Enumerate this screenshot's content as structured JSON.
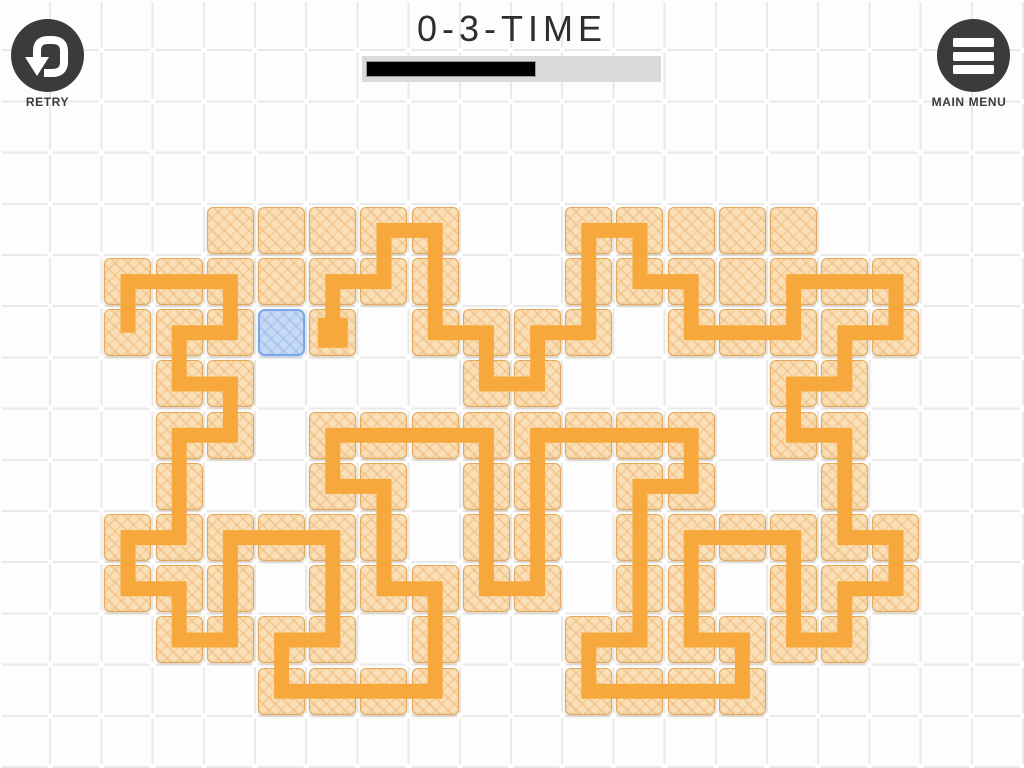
{
  "header": {
    "title": "0-3-TIME",
    "retry_label": "RETRY",
    "main_menu_label": "MAIN MENU",
    "progress": {
      "value_pct": 58
    }
  },
  "colors": {
    "path_orange": "#F7A83D",
    "tile_fill": "#FAE0B8",
    "tile_border": "#E0A050",
    "cursor_fill": "#C6DAF8",
    "cursor_border": "#79A7EA",
    "button_dark": "#3B3B3D",
    "progress_track": "#DADADA",
    "progress_fill": "#000000",
    "grid_line": "#E9E9E9",
    "title_color": "#2E2E2E"
  },
  "board": {
    "cell_size": 51.2,
    "cols": 20,
    "rows": 15,
    "path_width": 15,
    "start_marker_size": 30,
    "cursor_cell": [
      5,
      6
    ],
    "start_cell": [
      6,
      6
    ],
    "tiles": [
      [
        4,
        4
      ],
      [
        5,
        4
      ],
      [
        6,
        4
      ],
      [
        7,
        4
      ],
      [
        8,
        4
      ],
      [
        11,
        4
      ],
      [
        12,
        4
      ],
      [
        13,
        4
      ],
      [
        14,
        4
      ],
      [
        15,
        4
      ],
      [
        2,
        5
      ],
      [
        3,
        5
      ],
      [
        4,
        5
      ],
      [
        5,
        5
      ],
      [
        6,
        5
      ],
      [
        7,
        5
      ],
      [
        8,
        5
      ],
      [
        11,
        5
      ],
      [
        12,
        5
      ],
      [
        13,
        5
      ],
      [
        14,
        5
      ],
      [
        15,
        5
      ],
      [
        16,
        5
      ],
      [
        17,
        5
      ],
      [
        2,
        6
      ],
      [
        3,
        6
      ],
      [
        4,
        6
      ],
      [
        6,
        6
      ],
      [
        8,
        6
      ],
      [
        9,
        6
      ],
      [
        10,
        6
      ],
      [
        11,
        6
      ],
      [
        13,
        6
      ],
      [
        14,
        6
      ],
      [
        15,
        6
      ],
      [
        16,
        6
      ],
      [
        17,
        6
      ],
      [
        3,
        7
      ],
      [
        4,
        7
      ],
      [
        9,
        7
      ],
      [
        10,
        7
      ],
      [
        15,
        7
      ],
      [
        16,
        7
      ],
      [
        3,
        8
      ],
      [
        4,
        8
      ],
      [
        6,
        8
      ],
      [
        7,
        8
      ],
      [
        8,
        8
      ],
      [
        9,
        8
      ],
      [
        10,
        8
      ],
      [
        11,
        8
      ],
      [
        12,
        8
      ],
      [
        13,
        8
      ],
      [
        15,
        8
      ],
      [
        16,
        8
      ],
      [
        3,
        9
      ],
      [
        6,
        9
      ],
      [
        7,
        9
      ],
      [
        9,
        9
      ],
      [
        10,
        9
      ],
      [
        12,
        9
      ],
      [
        13,
        9
      ],
      [
        16,
        9
      ],
      [
        2,
        10
      ],
      [
        3,
        10
      ],
      [
        4,
        10
      ],
      [
        5,
        10
      ],
      [
        6,
        10
      ],
      [
        7,
        10
      ],
      [
        9,
        10
      ],
      [
        10,
        10
      ],
      [
        12,
        10
      ],
      [
        13,
        10
      ],
      [
        14,
        10
      ],
      [
        15,
        10
      ],
      [
        16,
        10
      ],
      [
        17,
        10
      ],
      [
        2,
        11
      ],
      [
        3,
        11
      ],
      [
        4,
        11
      ],
      [
        6,
        11
      ],
      [
        7,
        11
      ],
      [
        8,
        11
      ],
      [
        9,
        11
      ],
      [
        10,
        11
      ],
      [
        12,
        11
      ],
      [
        13,
        11
      ],
      [
        15,
        11
      ],
      [
        16,
        11
      ],
      [
        17,
        11
      ],
      [
        3,
        12
      ],
      [
        4,
        12
      ],
      [
        5,
        12
      ],
      [
        6,
        12
      ],
      [
        8,
        12
      ],
      [
        11,
        12
      ],
      [
        12,
        12
      ],
      [
        13,
        12
      ],
      [
        14,
        12
      ],
      [
        15,
        12
      ],
      [
        16,
        12
      ],
      [
        5,
        13
      ],
      [
        6,
        13
      ],
      [
        7,
        13
      ],
      [
        8,
        13
      ],
      [
        11,
        13
      ],
      [
        12,
        13
      ],
      [
        13,
        13
      ],
      [
        14,
        13
      ]
    ],
    "path_points": [
      [
        332.8,
        332.8
      ],
      [
        332.8,
        281.6
      ],
      [
        384,
        281.6
      ],
      [
        384,
        230.4
      ],
      [
        435.2,
        230.4
      ],
      [
        435.2,
        332.8
      ],
      [
        486.4,
        332.8
      ],
      [
        486.4,
        384
      ],
      [
        537.6,
        384
      ],
      [
        537.6,
        332.8
      ],
      [
        588.8,
        332.8
      ],
      [
        588.8,
        230.4
      ],
      [
        640,
        230.4
      ],
      [
        640,
        281.6
      ],
      [
        691.2,
        281.6
      ],
      [
        691.2,
        332.8
      ],
      [
        793.6,
        332.8
      ],
      [
        793.6,
        281.6
      ],
      [
        896,
        281.6
      ],
      [
        896,
        332.8
      ],
      [
        844.8,
        332.8
      ],
      [
        844.8,
        384
      ],
      [
        793.6,
        384
      ],
      [
        793.6,
        435.2
      ],
      [
        844.8,
        435.2
      ],
      [
        844.8,
        537.6
      ],
      [
        896,
        537.6
      ],
      [
        896,
        588.8
      ],
      [
        844.8,
        588.8
      ],
      [
        844.8,
        640
      ],
      [
        793.6,
        640
      ],
      [
        793.6,
        537.6
      ],
      [
        691.2,
        537.6
      ],
      [
        691.2,
        640
      ],
      [
        742.4,
        640
      ],
      [
        742.4,
        691.2
      ],
      [
        588.8,
        691.2
      ],
      [
        588.8,
        640
      ],
      [
        640,
        640
      ],
      [
        640,
        486.4
      ],
      [
        691.2,
        486.4
      ],
      [
        691.2,
        435.2
      ],
      [
        537.6,
        435.2
      ],
      [
        537.6,
        588.8
      ],
      [
        486.4,
        588.8
      ],
      [
        486.4,
        435.2
      ],
      [
        332.8,
        435.2
      ],
      [
        332.8,
        486.4
      ],
      [
        384,
        486.4
      ],
      [
        384,
        588.8
      ],
      [
        435.2,
        588.8
      ],
      [
        435.2,
        691.2
      ],
      [
        281.6,
        691.2
      ],
      [
        281.6,
        640
      ],
      [
        332.8,
        640
      ],
      [
        332.8,
        537.6
      ],
      [
        230.4,
        537.6
      ],
      [
        230.4,
        640
      ],
      [
        179.2,
        640
      ],
      [
        179.2,
        588.8
      ],
      [
        128,
        588.8
      ],
      [
        128,
        537.6
      ],
      [
        179.2,
        537.6
      ],
      [
        179.2,
        435.2
      ],
      [
        230.4,
        435.2
      ],
      [
        230.4,
        384
      ],
      [
        179.2,
        384
      ],
      [
        179.2,
        332.8
      ],
      [
        230.4,
        332.8
      ],
      [
        230.4,
        281.6
      ],
      [
        128,
        281.6
      ],
      [
        128,
        332.8
      ]
    ]
  }
}
